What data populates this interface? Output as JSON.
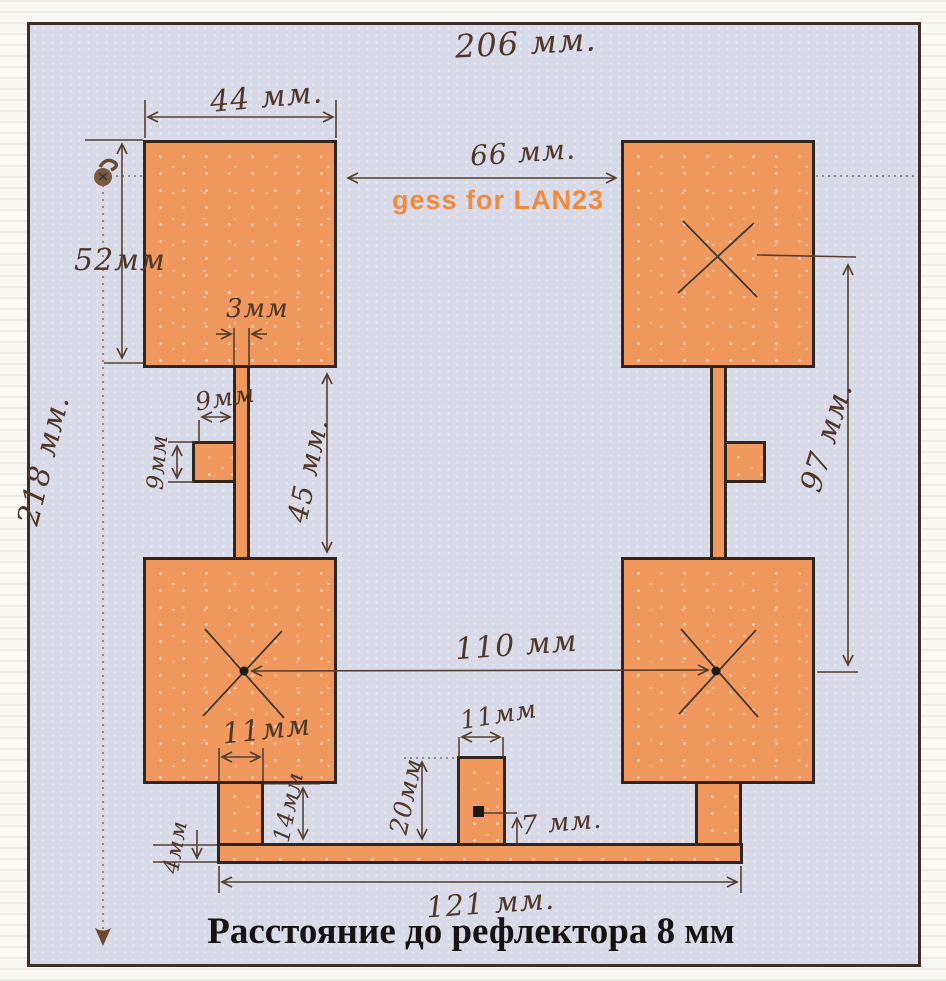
{
  "caption": "Расстояние до рефлектора 8 мм",
  "watermark": {
    "text": "gess for LAN23",
    "color": "#f08a3e"
  },
  "colors": {
    "copper": "#f0985d",
    "paper": "#d9dae7",
    "outline": "#2e2620",
    "ink": "#4d382a",
    "dotted_line": "#a0644a"
  },
  "dimensions": {
    "total_width": "206 мм.",
    "patch_width": "44 мм.",
    "top_gap": "66 мм.",
    "patch_height": "52мм",
    "total_height": "218 мм.",
    "strip_width": "3мм",
    "stub_offset": "9мм",
    "stub_size": "9мм",
    "strip_length": "45 мм.",
    "right_span": "97 мм.",
    "center_spacing": "110 мм",
    "leg_width": "11мм",
    "leg_height": "14мм",
    "bar_thickness": "4мм",
    "feed_width": "11мм",
    "feed_height": "20мм",
    "feed_offset": "7 мм.",
    "bar_length": "121 мм."
  }
}
